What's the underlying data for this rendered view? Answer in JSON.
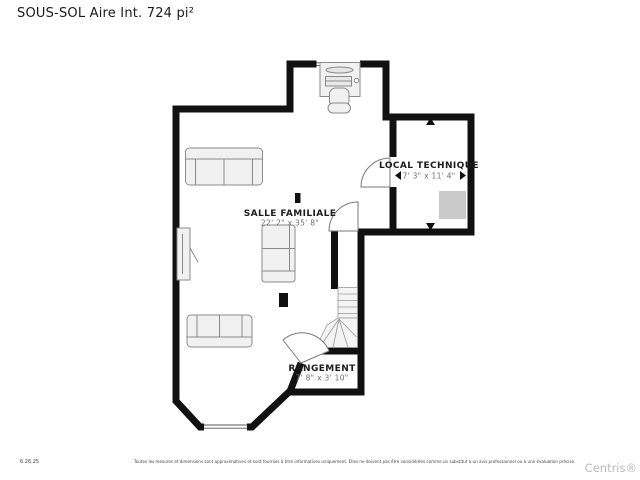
{
  "title": "SOUS-SOL Aire Int. 724 pi²",
  "plan": {
    "rooms": [
      {
        "name": "SALLE FAMILIALE",
        "dims": "22' 2\" x 35' 8\""
      },
      {
        "name": "LOCAL TECHNIQUE",
        "dims": "7' 3\" x 11' 4\""
      },
      {
        "name": "RANGEMENT",
        "dims": "7' 8\" x 3' 10\""
      }
    ]
  },
  "footer": {
    "date": "6.26.25",
    "disclaimer": "Toutes les mesures et dimensions sont approximatives et sont fournies à titre informatives uniquement. Elles ne doivent pas être considérées comme un substitut à un avis professionnel ou à une évaluation précise.",
    "watermark": "Centris®"
  },
  "colors": {
    "wall": "#111111",
    "furniture_fill": "#f1f1f1",
    "furniture_stroke": "#8a8a8a",
    "equipment_fill": "#c9c9c9",
    "room_label": "#1c1c1c",
    "dim_label": "#6e6e6e",
    "watermark": "#b9b9b9"
  }
}
